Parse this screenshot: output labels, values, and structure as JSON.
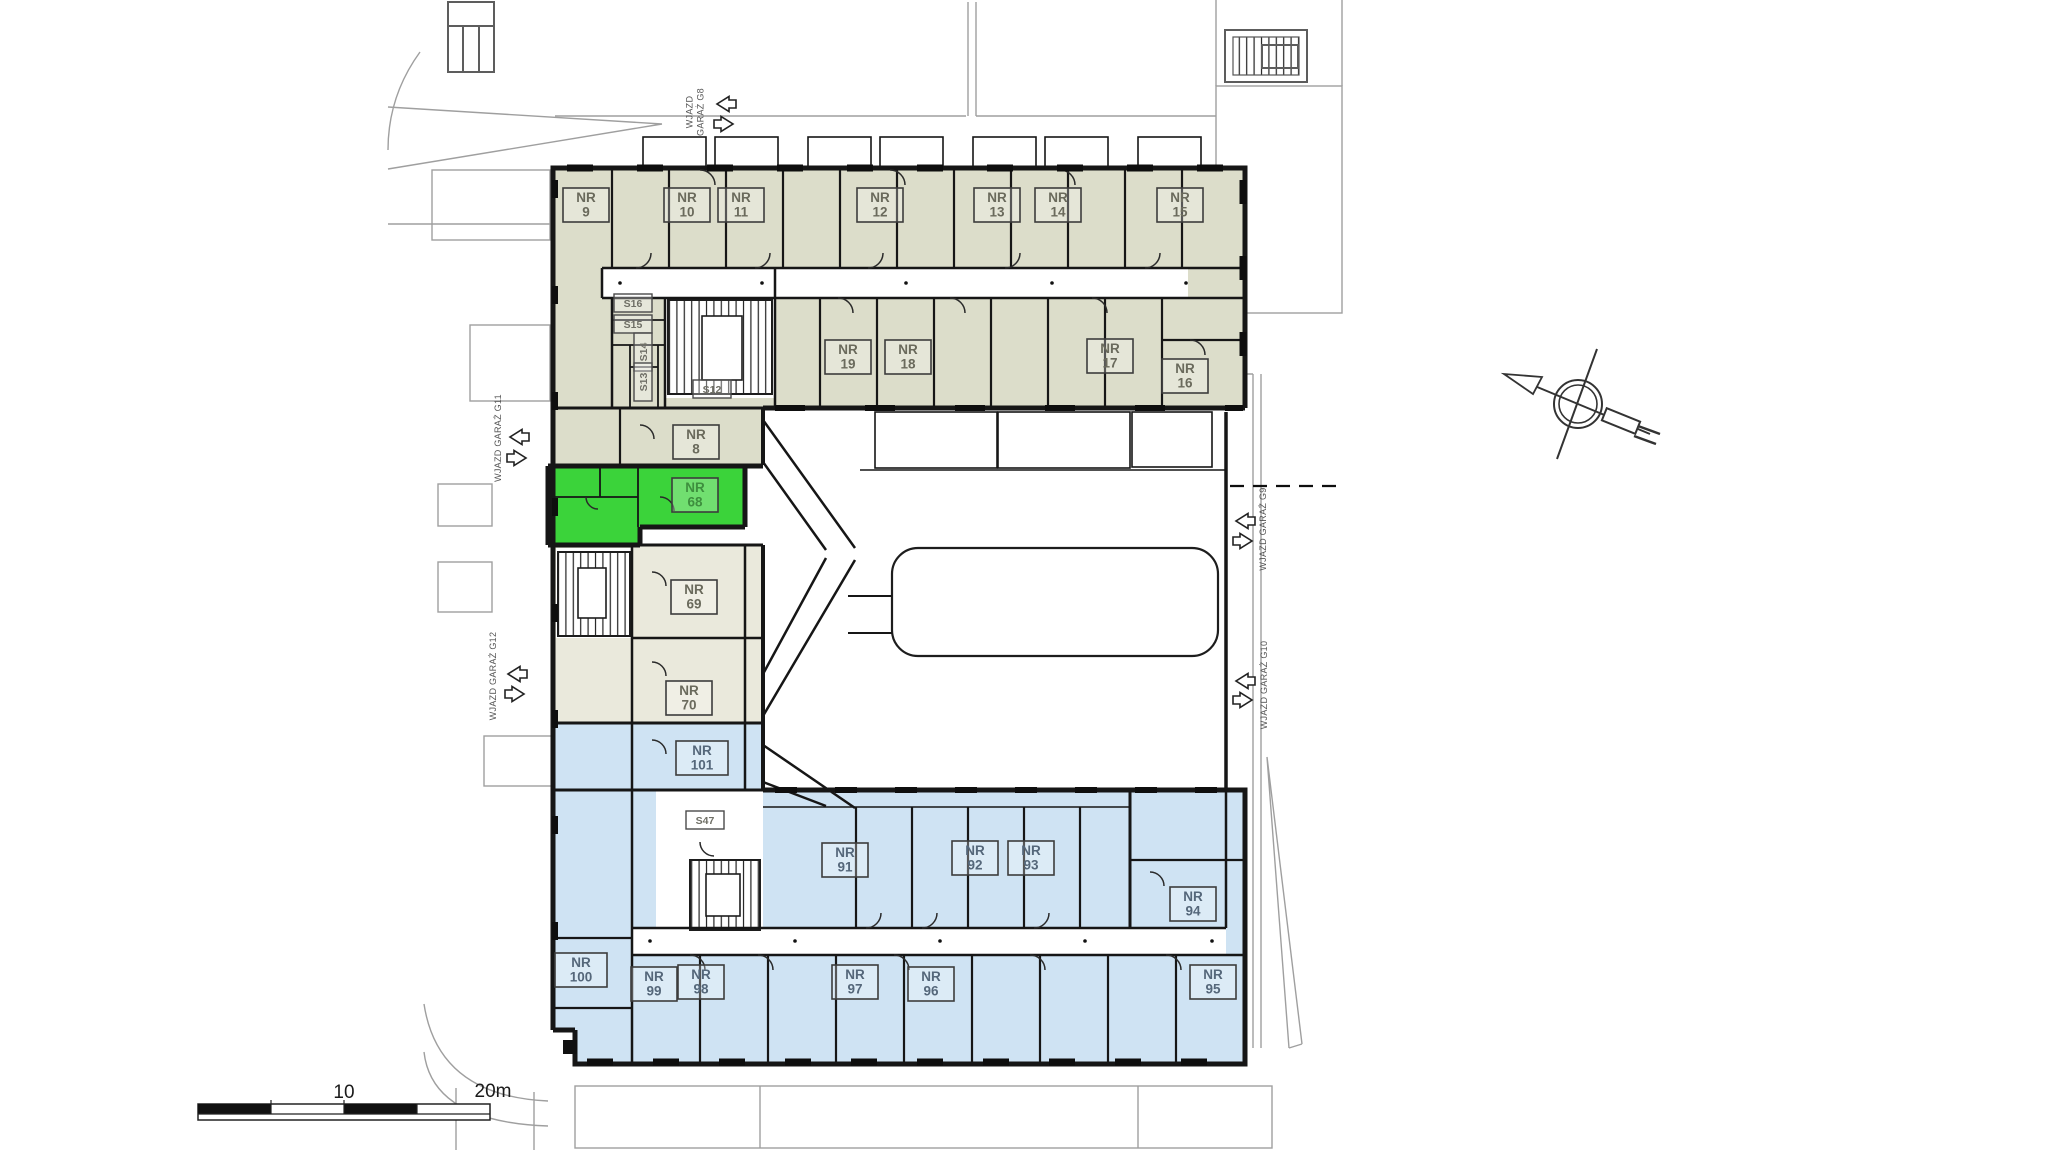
{
  "drawing": {
    "kind": "building floor plan",
    "highlighted_unit": "NR 68"
  },
  "colors": {
    "zone_upper": "#dcddca",
    "zone_middle": "#eae9dc",
    "zone_lower": "#cfe3f3",
    "zone_highlight": "#3bd33a",
    "wall": "#161616",
    "site_line": "#9f9f9f",
    "label_upper": "#6a6a5c",
    "label_lower": "#55677a",
    "label_highlight": "#3e8f3e"
  },
  "rooms": [
    {
      "id": "nr-9",
      "lines": [
        "NR",
        "9"
      ],
      "x": 586,
      "y": 205,
      "zone": "upper"
    },
    {
      "id": "nr-10",
      "lines": [
        "NR",
        "10"
      ],
      "x": 687,
      "y": 205,
      "zone": "upper"
    },
    {
      "id": "nr-11",
      "lines": [
        "NR",
        "11"
      ],
      "x": 741,
      "y": 205,
      "zone": "upper"
    },
    {
      "id": "nr-12",
      "lines": [
        "NR",
        "12"
      ],
      "x": 880,
      "y": 205,
      "zone": "upper"
    },
    {
      "id": "nr-13",
      "lines": [
        "NR",
        "13"
      ],
      "x": 997,
      "y": 205,
      "zone": "upper"
    },
    {
      "id": "nr-14",
      "lines": [
        "NR",
        "14"
      ],
      "x": 1058,
      "y": 205,
      "zone": "upper"
    },
    {
      "id": "nr-15",
      "lines": [
        "NR",
        "15"
      ],
      "x": 1180,
      "y": 205,
      "zone": "upper"
    },
    {
      "id": "nr-19",
      "lines": [
        "NR",
        "19"
      ],
      "x": 848,
      "y": 357,
      "zone": "upper"
    },
    {
      "id": "nr-18",
      "lines": [
        "NR",
        "18"
      ],
      "x": 908,
      "y": 357,
      "zone": "upper"
    },
    {
      "id": "nr-17",
      "lines": [
        "NR",
        "17"
      ],
      "x": 1110,
      "y": 356,
      "zone": "upper"
    },
    {
      "id": "nr-16",
      "lines": [
        "NR",
        "16"
      ],
      "x": 1185,
      "y": 376,
      "zone": "upper"
    },
    {
      "id": "nr-8",
      "lines": [
        "NR",
        "8"
      ],
      "x": 696,
      "y": 442,
      "zone": "upper"
    },
    {
      "id": "nr-68",
      "lines": [
        "NR",
        "68"
      ],
      "x": 695,
      "y": 495,
      "zone": "highlight"
    },
    {
      "id": "nr-69",
      "lines": [
        "NR",
        "69"
      ],
      "x": 694,
      "y": 597,
      "zone": "middle"
    },
    {
      "id": "nr-70",
      "lines": [
        "NR",
        "70"
      ],
      "x": 689,
      "y": 698,
      "zone": "middle"
    },
    {
      "id": "nr-101",
      "lines": [
        "NR",
        "101"
      ],
      "x": 702,
      "y": 758,
      "zone": "lower"
    },
    {
      "id": "nr-91",
      "lines": [
        "NR",
        "91"
      ],
      "x": 845,
      "y": 860,
      "zone": "lower"
    },
    {
      "id": "nr-92",
      "lines": [
        "NR",
        "92"
      ],
      "x": 975,
      "y": 858,
      "zone": "lower"
    },
    {
      "id": "nr-93",
      "lines": [
        "NR",
        "93"
      ],
      "x": 1031,
      "y": 858,
      "zone": "lower"
    },
    {
      "id": "nr-94",
      "lines": [
        "NR",
        "94"
      ],
      "x": 1193,
      "y": 904,
      "zone": "lower"
    },
    {
      "id": "nr-100",
      "lines": [
        "NR",
        "100"
      ],
      "x": 581,
      "y": 970,
      "zone": "lower"
    },
    {
      "id": "nr-99",
      "lines": [
        "NR",
        "99"
      ],
      "x": 654,
      "y": 984,
      "zone": "lower"
    },
    {
      "id": "nr-98",
      "lines": [
        "NR",
        "98"
      ],
      "x": 701,
      "y": 982,
      "zone": "lower"
    },
    {
      "id": "nr-97",
      "lines": [
        "NR",
        "97"
      ],
      "x": 855,
      "y": 982,
      "zone": "lower"
    },
    {
      "id": "nr-96",
      "lines": [
        "NR",
        "96"
      ],
      "x": 931,
      "y": 984,
      "zone": "lower"
    },
    {
      "id": "nr-95",
      "lines": [
        "NR",
        "95"
      ],
      "x": 1213,
      "y": 982,
      "zone": "lower"
    }
  ],
  "service_labels": [
    {
      "id": "s16",
      "text": "S16",
      "x": 633,
      "y": 303,
      "rotate": 0
    },
    {
      "id": "s15",
      "text": "S15",
      "x": 633,
      "y": 324,
      "rotate": 0
    },
    {
      "id": "s14",
      "text": "S14",
      "x": 643,
      "y": 352,
      "rotate": -90
    },
    {
      "id": "s13",
      "text": "S13",
      "x": 643,
      "y": 382,
      "rotate": -90
    },
    {
      "id": "s12",
      "text": "S12",
      "x": 712,
      "y": 389,
      "rotate": 0
    },
    {
      "id": "s47",
      "text": "S47",
      "x": 705,
      "y": 820,
      "rotate": 0
    }
  ],
  "garage_entries": [
    {
      "id": "g8",
      "lines": [
        "WJAZD",
        "GARAŻ G8"
      ],
      "tx": 698,
      "ty": 112,
      "ax": 725,
      "ay1": 104,
      "ay2": 124
    },
    {
      "id": "g11",
      "lines": [
        "WJAZD GARAŻ G11"
      ],
      "tx": 501,
      "ty": 438,
      "ax": 518,
      "ay1": 437,
      "ay2": 458
    },
    {
      "id": "g12",
      "lines": [
        "WJAZD GARAŻ G12"
      ],
      "tx": 496,
      "ty": 676,
      "ax": 516,
      "ay1": 674,
      "ay2": 694
    },
    {
      "id": "g9",
      "lines": [
        "WJAZD GARAŻ G9"
      ],
      "tx": 1266,
      "ty": 529,
      "ax": 1244,
      "ay1": 521,
      "ay2": 541
    },
    {
      "id": "g10",
      "lines": [
        "WJAZD GARAŻ G10"
      ],
      "tx": 1267,
      "ty": 685,
      "ax": 1244,
      "ay1": 681,
      "ay2": 700
    }
  ],
  "scale_bar": {
    "mid_label": "10",
    "end_label": "20m"
  }
}
